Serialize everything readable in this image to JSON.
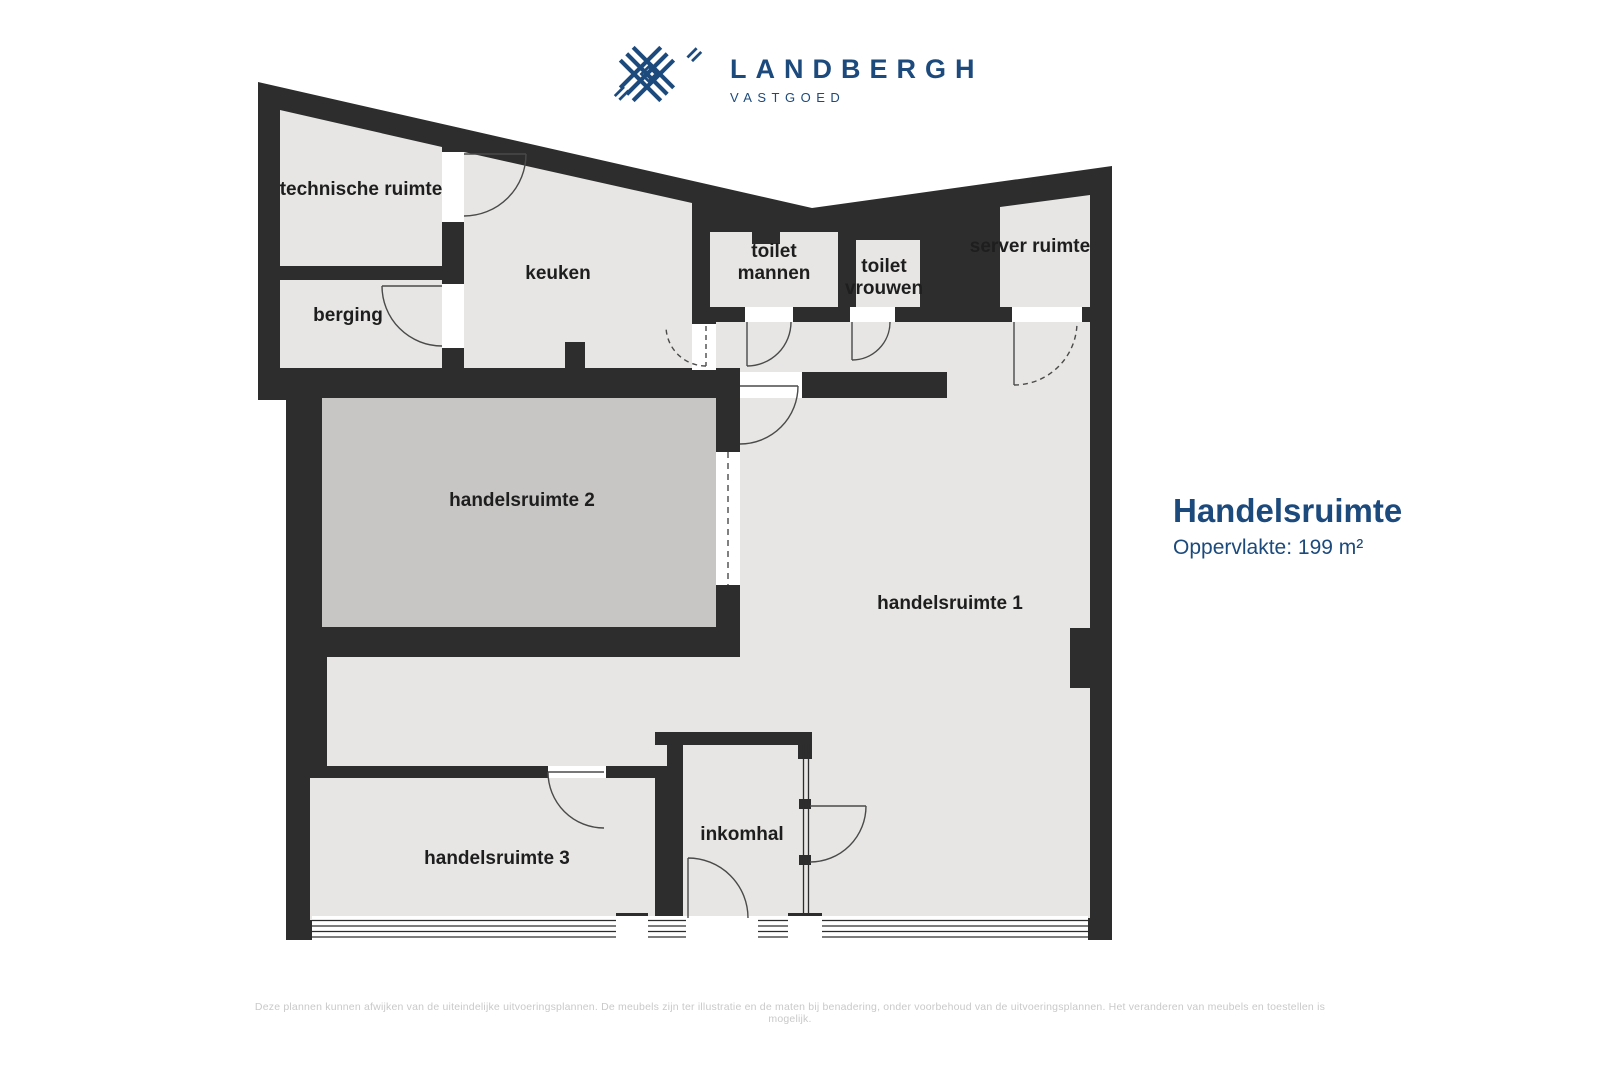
{
  "logo": {
    "name": "LANDBERGH",
    "tagline": "VASTGOED"
  },
  "panel": {
    "title": "Handelsruimte",
    "area_label": "Oppervlakte: 199 m²"
  },
  "rooms": {
    "technische_ruimte": {
      "label": "technische ruimte"
    },
    "berging": {
      "label": "berging"
    },
    "keuken": {
      "label": "keuken"
    },
    "toilet_mannen": {
      "line1": "toilet",
      "line2": "mannen"
    },
    "toilet_vrouwen": {
      "line1": "toilet",
      "line2": "vrouwen"
    },
    "server_ruimte": {
      "label": "server ruimte"
    },
    "handelsruimte_1": {
      "label": "handelsruimte 1"
    },
    "handelsruimte_2": {
      "label": "handelsruimte 2"
    },
    "handelsruimte_3": {
      "label": "handelsruimte 3"
    },
    "inkomhal": {
      "label": "inkomhal"
    }
  },
  "footer": {
    "disclaimer": "Deze plannen kunnen afwijken van de uiteindelijke uitvoeringsplannen. De meubels zijn ter illustratie en de maten bij benadering, onder voorbehoud van de uitvoeringsplannen. Het veranderen van meubels en toestellen is mogelijk."
  },
  "colors": {
    "brand": "#1c4a7c",
    "wall": "#2d2d2d",
    "floor_light": "#e7e6e4",
    "floor_dark": "#c7c6c4",
    "door_line": "#4a4a4a",
    "label_text": "#1e1e1e",
    "disclaimer_text": "#c9c9c9"
  }
}
